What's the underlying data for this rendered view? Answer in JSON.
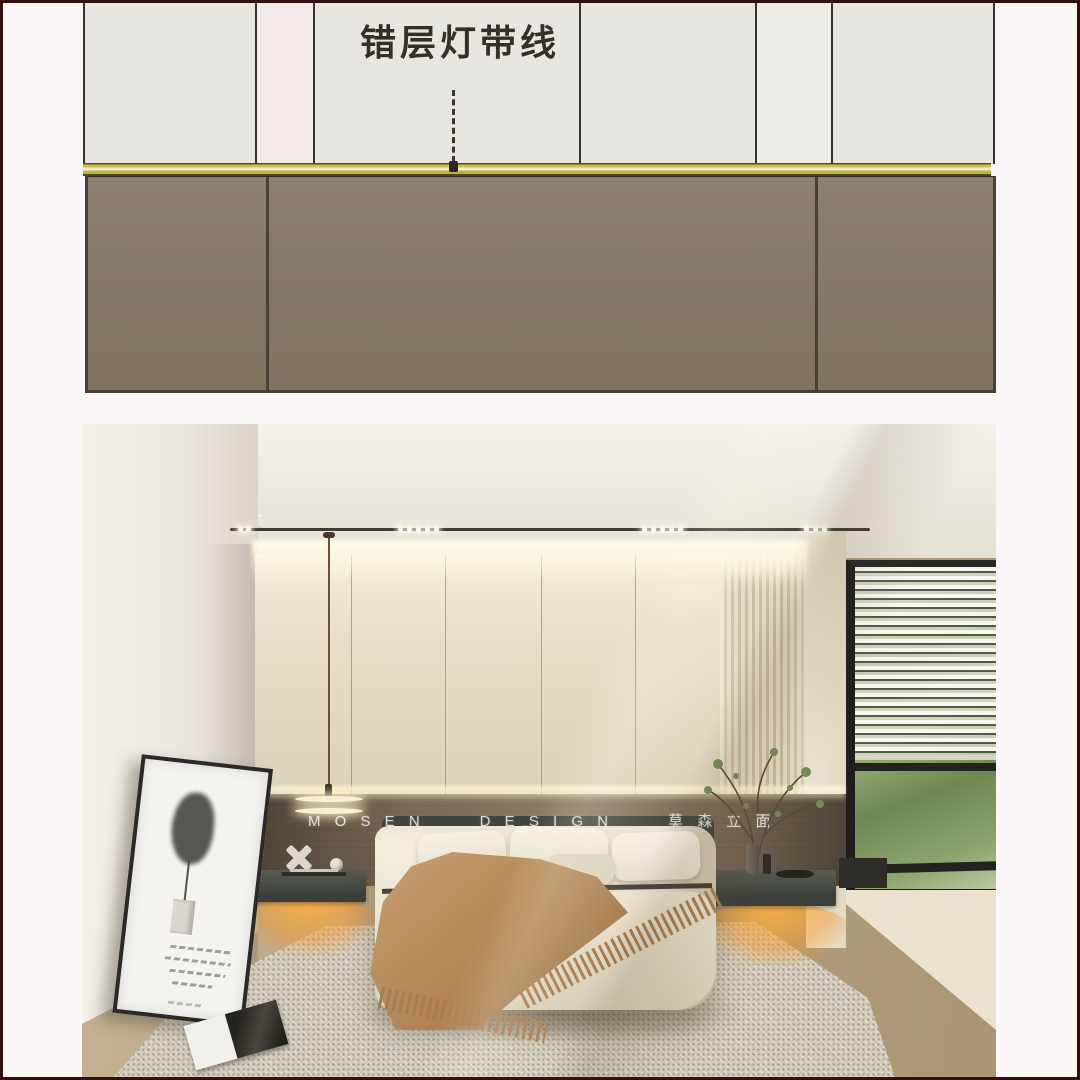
{
  "page": {
    "background": "#fbf6f7",
    "frame_color": "#330f10"
  },
  "diagram": {
    "annotation_label": "错层灯带线"
  },
  "photo": {
    "watermark": "M O S E N      D E S I G N      莫 森 立 面"
  },
  "colors": {
    "page-bg": "#fbf6f7",
    "frame": "#330f10",
    "panel": "#e8e6e1",
    "panel-line": "#35332e",
    "strip-yellow": "#cfc04a",
    "strip-pale": "#f3efcd",
    "strip-dark": "#4c451d",
    "taupe": "#847767",
    "taupe-line": "#4a4136",
    "label-ink": "#343028",
    "glow-orange": "#f5a93f",
    "wood-band": "#6e5f4e",
    "watermark-ink": "rgba(255,255,255,0.78)"
  }
}
